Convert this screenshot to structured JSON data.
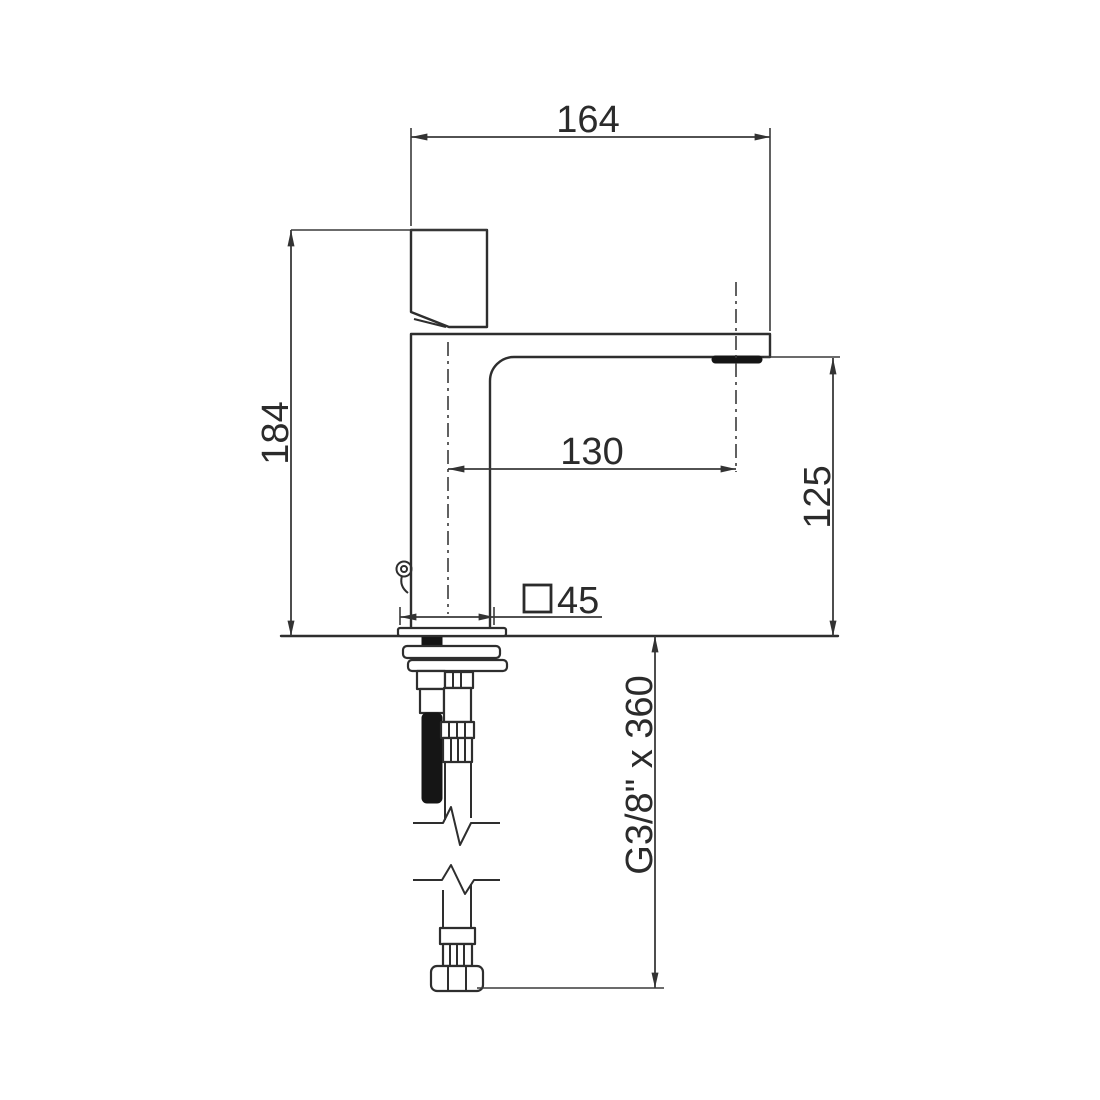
{
  "page": {
    "background": "#ffffff",
    "line_color": "#2e2e2e"
  },
  "drawing": {
    "subject": "basin-mixer-faucet-side-view",
    "dimensions": {
      "total_width": {
        "label": "164"
      },
      "total_height": {
        "label": "184"
      },
      "spout_reach": {
        "label": "130"
      },
      "spout_height": {
        "label": "125"
      },
      "base_width": {
        "label": "45",
        "symbol": "square"
      },
      "supply_hose": {
        "label": "G3/8\" x 360"
      }
    }
  }
}
